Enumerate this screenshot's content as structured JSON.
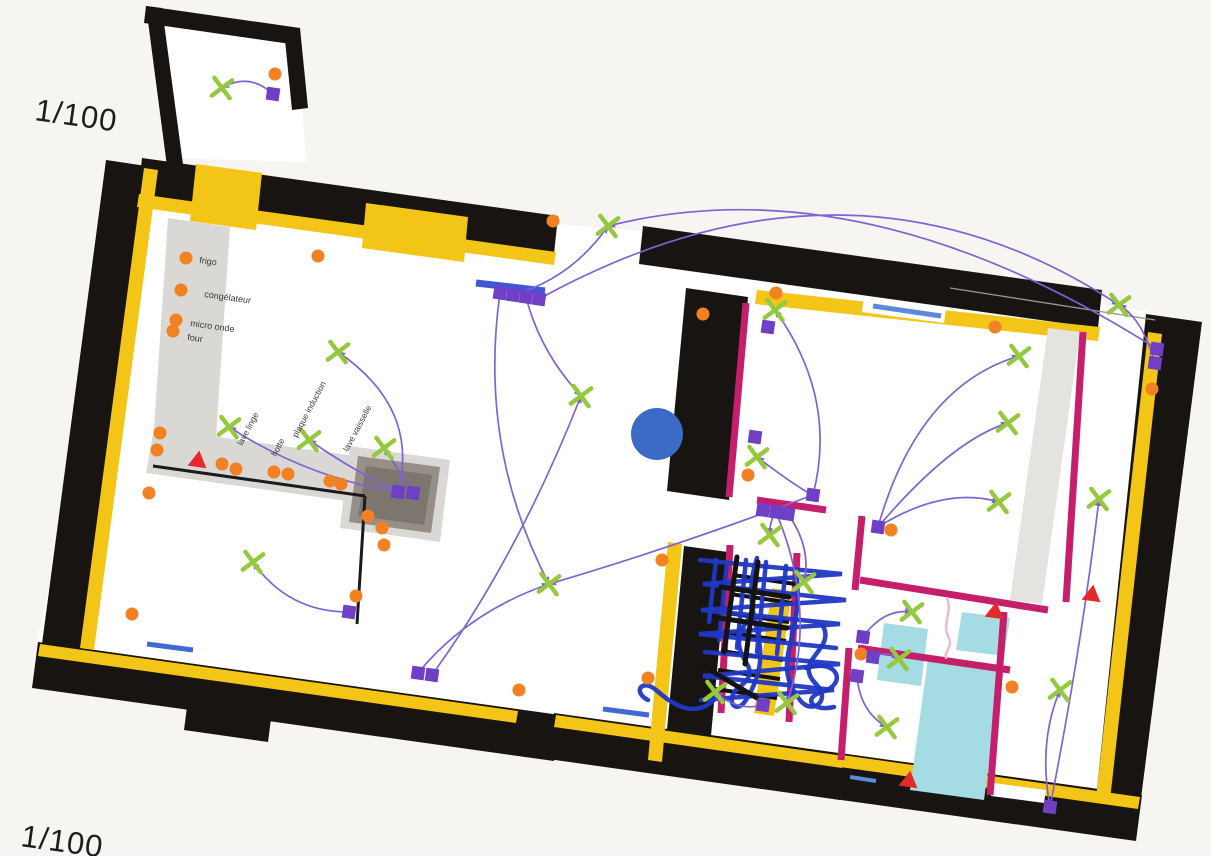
{
  "page": {
    "scale_top": "1/100",
    "scale_bottom": "1/100"
  },
  "colors": {
    "paper": "#f7f5f1",
    "wall_black": "#171411",
    "wall_liner_yellow": "#f3c517",
    "partition_magenta": "#c51f6b",
    "socket_orange": "#f28121",
    "light_green": "#94c83d",
    "switch_purple": "#6f3fc6",
    "arrow_purple": "#7e63d2",
    "alarm_red": "#e3292b",
    "window_blue": "#4156d2",
    "window_blue_light": "#5c8ada",
    "fixture_cyan": "#a5dbe2",
    "pen_blue": "#2038c4",
    "ceiling_rose_blue": "#3b6bc7",
    "label_ink": "#3a3a3a"
  },
  "kitchen_labels": [
    {
      "text": "frigo",
      "x": 199,
      "y": 263,
      "rot": 8
    },
    {
      "text": "congélateur",
      "x": 204,
      "y": 297,
      "rot": 8
    },
    {
      "text": "micro onde",
      "x": 190,
      "y": 326,
      "rot": 8
    },
    {
      "text": "four",
      "x": 187,
      "y": 340,
      "rot": 8
    }
  ],
  "counter_labels": [
    {
      "text": "lave linge",
      "x": 242,
      "y": 446,
      "rot": -62
    },
    {
      "text": "hotte",
      "x": 276,
      "y": 457,
      "rot": -62
    },
    {
      "text": "plaque induction",
      "x": 297,
      "y": 438,
      "rot": -62
    },
    {
      "text": "lave vaisselle",
      "x": 348,
      "y": 452,
      "rot": -62
    }
  ],
  "symbols": {
    "sockets": [
      [
        275,
        74
      ],
      [
        318,
        256
      ],
      [
        553,
        221
      ],
      [
        703,
        314
      ],
      [
        776,
        293
      ],
      [
        995,
        327
      ],
      [
        1152,
        389
      ],
      [
        186,
        258
      ],
      [
        181,
        290
      ],
      [
        176,
        320
      ],
      [
        173,
        331
      ],
      [
        160,
        433
      ],
      [
        157,
        450
      ],
      [
        149,
        493
      ],
      [
        132,
        614
      ],
      [
        222,
        464
      ],
      [
        236,
        469
      ],
      [
        274,
        472
      ],
      [
        288,
        474
      ],
      [
        330,
        481
      ],
      [
        341,
        484
      ],
      [
        368,
        516
      ],
      [
        382,
        528
      ],
      [
        384,
        545
      ],
      [
        356,
        596
      ],
      [
        662,
        560
      ],
      [
        648,
        678
      ],
      [
        519,
        690
      ],
      [
        748,
        475
      ],
      [
        891,
        530
      ],
      [
        861,
        654
      ],
      [
        1012,
        687
      ]
    ],
    "lights": [
      [
        222,
        88
      ],
      [
        608,
        226
      ],
      [
        338,
        352
      ],
      [
        229,
        427
      ],
      [
        309,
        440
      ],
      [
        384,
        448
      ],
      [
        581,
        396
      ],
      [
        549,
        584
      ],
      [
        253,
        562
      ],
      [
        775,
        310
      ],
      [
        757,
        457
      ],
      [
        770,
        535
      ],
      [
        804,
        582
      ],
      [
        715,
        692
      ],
      [
        787,
        703
      ],
      [
        1019,
        356
      ],
      [
        1008,
        423
      ],
      [
        999,
        502
      ],
      [
        1099,
        499
      ],
      [
        1119,
        305
      ],
      [
        1060,
        690
      ],
      [
        912,
        612
      ],
      [
        899,
        659
      ],
      [
        887,
        727
      ]
    ],
    "switches": [
      [
        273,
        94
      ],
      [
        500,
        293
      ],
      [
        513,
        295
      ],
      [
        526,
        297
      ],
      [
        539,
        299
      ],
      [
        398,
        492
      ],
      [
        413,
        493
      ],
      [
        349,
        612
      ],
      [
        418,
        673
      ],
      [
        432,
        675
      ],
      [
        755,
        437
      ],
      [
        813,
        495
      ],
      [
        763,
        510
      ],
      [
        776,
        512
      ],
      [
        788,
        514
      ],
      [
        768,
        327
      ],
      [
        878,
        527
      ],
      [
        1157,
        349
      ],
      [
        1155,
        363
      ],
      [
        863,
        637
      ],
      [
        873,
        657
      ],
      [
        857,
        676
      ],
      [
        763,
        705
      ],
      [
        1050,
        807
      ]
    ],
    "alarms": [
      [
        198,
        460
      ],
      [
        995,
        611
      ],
      [
        1092,
        594
      ],
      [
        909,
        780
      ]
    ]
  },
  "windows": [
    {
      "p": [
        476,
        283,
        545,
        291
      ],
      "w": 7,
      "c": "#4156d2"
    },
    {
      "p": [
        873,
        306,
        941,
        316
      ],
      "w": 5,
      "c": "#5c8ada"
    },
    {
      "p": [
        147,
        644,
        193,
        650
      ],
      "w": 5,
      "c": "#3f6ad2"
    },
    {
      "p": [
        603,
        709,
        649,
        715
      ],
      "w": 5,
      "c": "#3f6ad2"
    },
    {
      "p": [
        850,
        777,
        876,
        781
      ],
      "w": 4,
      "c": "#5c8ada"
    }
  ],
  "ceiling_rose": {
    "x": 657,
    "y": 434,
    "r": 26
  },
  "connections": [
    {
      "f": [
        273,
        94
      ],
      "t": [
        222,
        88
      ],
      "c": [
        249,
        72
      ]
    },
    {
      "f": [
        398,
        492
      ],
      "t": [
        338,
        352
      ],
      "c": [
        420,
        408
      ]
    },
    {
      "f": [
        398,
        492
      ],
      "t": [
        309,
        440
      ],
      "c": [
        352,
        470
      ]
    },
    {
      "f": [
        398,
        492
      ],
      "t": [
        229,
        427
      ],
      "c": [
        308,
        478
      ]
    },
    {
      "f": [
        413,
        493
      ],
      "t": [
        384,
        448
      ],
      "c": [
        400,
        472
      ]
    },
    {
      "f": [
        513,
        295
      ],
      "t": [
        608,
        226
      ],
      "c": [
        572,
        278
      ]
    },
    {
      "f": [
        539,
        299
      ],
      "t": [
        1119,
        305
      ],
      "c": [
        850,
        128
      ]
    },
    {
      "f": [
        1157,
        349
      ],
      "t": [
        608,
        226
      ],
      "c": [
        862,
        162
      ]
    },
    {
      "f": [
        526,
        297
      ],
      "t": [
        581,
        396
      ],
      "c": [
        540,
        352
      ]
    },
    {
      "f": [
        500,
        293
      ],
      "t": [
        549,
        584
      ],
      "c": [
        478,
        448
      ]
    },
    {
      "f": [
        418,
        673
      ],
      "t": [
        549,
        584
      ],
      "c": [
        468,
        612
      ]
    },
    {
      "f": [
        432,
        675
      ],
      "t": [
        581,
        396
      ],
      "c": [
        518,
        556
      ]
    },
    {
      "f": [
        813,
        495
      ],
      "t": [
        757,
        457
      ],
      "c": [
        798,
        488
      ]
    },
    {
      "f": [
        813,
        495
      ],
      "t": [
        775,
        310
      ],
      "c": [
        838,
        398
      ]
    },
    {
      "f": [
        813,
        495
      ],
      "t": [
        549,
        584
      ],
      "c": [
        672,
        548
      ]
    },
    {
      "f": [
        776,
        512
      ],
      "t": [
        770,
        535
      ],
      "c": [
        769,
        522
      ]
    },
    {
      "f": [
        788,
        514
      ],
      "t": [
        804,
        582
      ],
      "c": [
        812,
        548
      ]
    },
    {
      "f": [
        776,
        512
      ],
      "t": [
        787,
        703
      ],
      "c": [
        818,
        612
      ]
    },
    {
      "f": [
        763,
        705
      ],
      "t": [
        715,
        692
      ],
      "c": [
        738,
        712
      ]
    },
    {
      "f": [
        878,
        527
      ],
      "t": [
        1008,
        423
      ],
      "c": [
        952,
        440
      ]
    },
    {
      "f": [
        878,
        527
      ],
      "t": [
        999,
        502
      ],
      "c": [
        944,
        486
      ]
    },
    {
      "f": [
        878,
        527
      ],
      "t": [
        1019,
        356
      ],
      "c": [
        918,
        386
      ]
    },
    {
      "f": [
        863,
        637
      ],
      "t": [
        912,
        612
      ],
      "c": [
        884,
        608
      ]
    },
    {
      "f": [
        873,
        657
      ],
      "t": [
        899,
        659
      ],
      "c": [
        886,
        650
      ]
    },
    {
      "f": [
        857,
        676
      ],
      "t": [
        887,
        727
      ],
      "c": [
        860,
        712
      ]
    },
    {
      "f": [
        349,
        612
      ],
      "t": [
        253,
        562
      ],
      "c": [
        288,
        612
      ]
    },
    {
      "f": [
        1050,
        807
      ],
      "t": [
        1060,
        690
      ],
      "c": [
        1038,
        742
      ]
    },
    {
      "f": [
        1050,
        807
      ],
      "t": [
        1099,
        499
      ],
      "c": [
        1082,
        644
      ]
    },
    {
      "f": [
        1155,
        363
      ],
      "t": [
        1119,
        305
      ],
      "c": [
        1142,
        318
      ]
    }
  ],
  "stairs": {
    "treads": [
      [
        733,
        575,
        795,
        584
      ],
      [
        730,
        594,
        792,
        603
      ],
      [
        727,
        613,
        789,
        622
      ],
      [
        724,
        632,
        786,
        641
      ],
      [
        721,
        651,
        783,
        660
      ],
      [
        718,
        670,
        780,
        679
      ],
      [
        715,
        689,
        777,
        698
      ]
    ]
  },
  "scribbles": {
    "blue": [
      "M700,560 L842,574 L703,584 L846,600 L701,610 L840,624 L699,634 L836,648",
      "M705,652 L840,664 L703,676 L834,690 L701,700",
      "M757,558 C736,620 782,642 746,700 C736,716 724,700 738,688 C772,664 718,660 749,618",
      "M796,572 C806,638 768,660 800,700 C812,716 832,700 816,684 C792,660 836,650 823,626",
      "M714,700 C692,720 670,702 656,690 C642,678 632,692 648,700",
      "M806,668 C838,658 848,684 822,692 C802,698 812,712 834,707",
      "M716,560 L709,622 M727,563 L719,640 M746,560 L737,648 M766,562 L757,652 M786,566 L777,654"
    ],
    "black": [
      "M737,557 L724,652",
      "M758,562 L745,664",
      "M700,664 L757,698",
      "M721,587 L789,597",
      "M719,618 L787,628"
    ],
    "pink": [
      "M947,598 C953,612 941,624 949,638 C953,646 944,652 946,658"
    ]
  }
}
